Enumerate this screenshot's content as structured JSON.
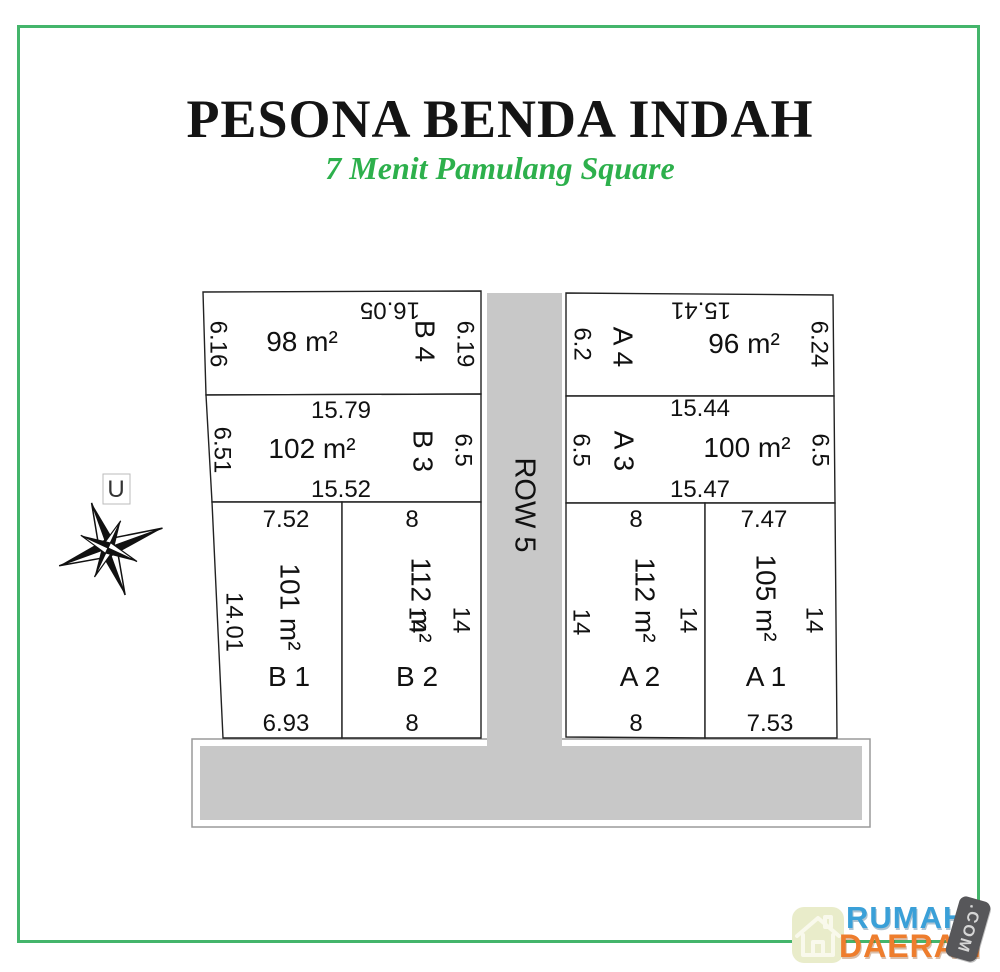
{
  "title": "PESONA BENDA INDAH",
  "subtitle": "7 Menit Pamulang Square",
  "compass": {
    "north_label": "U"
  },
  "road": {
    "label": "ROW 5"
  },
  "colors": {
    "frame_green": "#44b56b",
    "subtitle_green": "#2db04c",
    "road_gray": "#c8c8c8",
    "logo_blue": "#3aa0d8",
    "logo_orange": "#ee7d2d",
    "logo_tag_gray": "#57575a",
    "logo_tile": "#e9ecca"
  },
  "plots": [
    {
      "label": "B 4",
      "area": "98 m²",
      "top": "16.05",
      "left": "6.16",
      "right": "6.19"
    },
    {
      "label": "B 3",
      "area": "102 m²",
      "top": "15.79",
      "bottom": "15.52",
      "left": "6.51",
      "right": "6.5"
    },
    {
      "label": "B 1",
      "area": "101 m²",
      "top": "7.52",
      "bottom": "6.93",
      "left": "14.01",
      "right": "14"
    },
    {
      "label": "B 2",
      "area": "112 m²",
      "top": "8",
      "bottom": "8",
      "right": "14"
    },
    {
      "label": "A 4",
      "area": "96 m²",
      "top": "15.41",
      "left": "6.2",
      "right": "6.24"
    },
    {
      "label": "A 3",
      "area": "100 m²",
      "top": "15.44",
      "bottom": "15.47",
      "left": "6.5",
      "right": "6.5"
    },
    {
      "label": "A 2",
      "area": "112 m²",
      "top": "8",
      "bottom": "8",
      "left": "14",
      "right": "14"
    },
    {
      "label": "A 1",
      "area": "105 m²",
      "top": "7.47",
      "bottom": "7.53",
      "right": "14"
    }
  ],
  "logo": {
    "line1": "RUMAH",
    "line2": "DAERAH",
    "tag": ".COM"
  }
}
